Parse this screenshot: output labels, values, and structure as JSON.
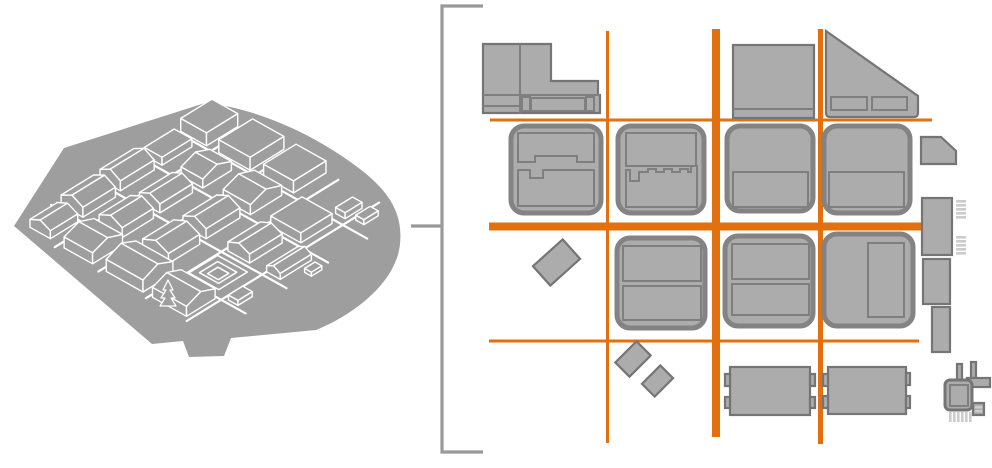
{
  "figure": {
    "kind": "urban-design-diagram",
    "description": "Isometric gray massing model of a city district on the left, linked by a bracket to an orthogonal figure-ground street plan on the right"
  },
  "colors": {
    "background": "#ffffff",
    "street_orange": "#e2700e",
    "block_fill": "#acacac",
    "block_stroke": "#757575",
    "rounded_block_stroke": "#838383",
    "detail_stroke": "#7f7f7f",
    "hatch_gray": "#cccccc",
    "model_gray": "#9e9e9e",
    "model_line": "#ffffff",
    "bracket_gray": "#999999"
  },
  "model": {
    "label": "isometric massing model",
    "building_count": 23,
    "has_tree": true,
    "has_courtyard": true
  },
  "plan": {
    "label": "figure-ground plan with highlighted streets",
    "horizontal_streets": 3,
    "vertical_streets": 3,
    "rounded_blocks": 7
  },
  "bracket": {
    "label": "callout bracket linking model to plan"
  }
}
